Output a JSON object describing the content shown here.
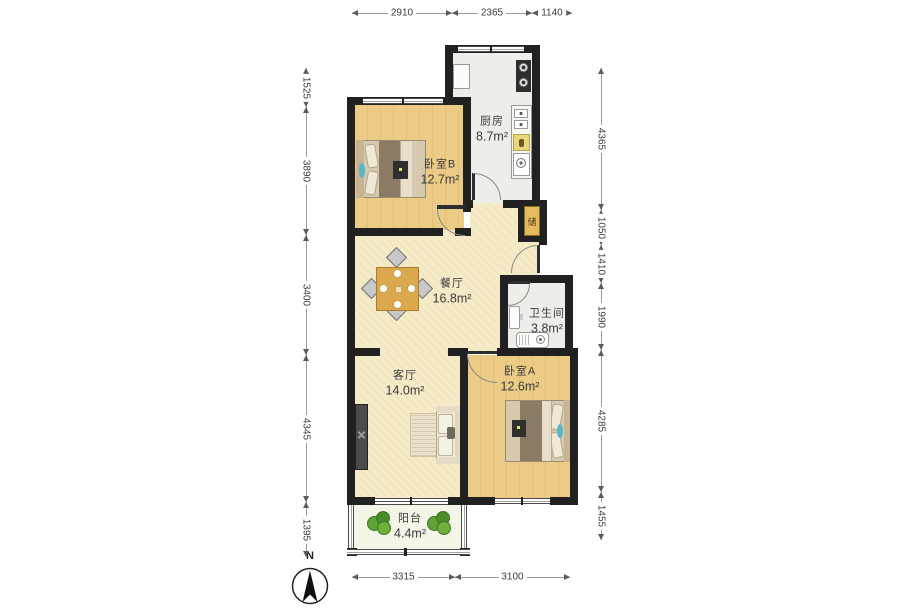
{
  "page": {
    "title": "Floor Plan"
  },
  "colors": {
    "wall": "#212121",
    "wood_floor": "#EBCB85",
    "cream_floor": "#F5EBC8",
    "tile_floor": "#EDEEE9",
    "balcony_floor": "#F3F5E6",
    "storage_cabinet": "#E4BC60",
    "plant_green": "#5FA235",
    "dim_line": "#9B9B9B",
    "dim_text": "#3C3C3C"
  },
  "compass": {
    "label": "N"
  },
  "storage": {
    "label": "储"
  },
  "rooms": [
    {
      "id": "kitchen",
      "name": "厨房",
      "area": "8.7m²",
      "cx": 492,
      "cy": 128
    },
    {
      "id": "bedroom-b",
      "name": "卧室B",
      "area": "12.7m²",
      "cx": 440,
      "cy": 171
    },
    {
      "id": "dining-room",
      "name": "餐厅",
      "area": "16.8m²",
      "cx": 452,
      "cy": 290
    },
    {
      "id": "bathroom",
      "name": "卫生间",
      "area": "3.8m²",
      "cx": 547,
      "cy": 320
    },
    {
      "id": "living-room",
      "name": "客厅",
      "area": "14.0m²",
      "cx": 405,
      "cy": 382
    },
    {
      "id": "bedroom-a",
      "name": "卧室A",
      "area": "12.6m²",
      "cx": 520,
      "cy": 378
    },
    {
      "id": "balcony",
      "name": "阳台",
      "area": "4.4m²",
      "cx": 410,
      "cy": 525
    }
  ],
  "dimensions": {
    "top": {
      "orientation": "h",
      "pos": 14,
      "segments": [
        {
          "label": "2910",
          "from": 352,
          "to": 452
        },
        {
          "label": "2365",
          "from": 452,
          "to": 532
        },
        {
          "label": "1140",
          "from": 532,
          "to": 572
        }
      ]
    },
    "bottom": {
      "orientation": "h",
      "pos": 578,
      "segments": [
        {
          "label": "3315",
          "from": 352,
          "to": 455
        },
        {
          "label": "3100",
          "from": 455,
          "to": 570
        }
      ]
    },
    "left": {
      "orientation": "v",
      "pos": 307,
      "segments": [
        {
          "label": "1525",
          "from": 68,
          "to": 107
        },
        {
          "label": "3890",
          "from": 107,
          "to": 235
        },
        {
          "label": "3400",
          "from": 235,
          "to": 355
        },
        {
          "label": "4345",
          "from": 355,
          "to": 502
        },
        {
          "label": "1395",
          "from": 502,
          "to": 557
        }
      ]
    },
    "right": {
      "orientation": "v",
      "pos": 602,
      "segments": [
        {
          "label": "4365",
          "from": 68,
          "to": 210
        },
        {
          "label": "1050",
          "from": 210,
          "to": 245
        },
        {
          "label": "1410",
          "from": 245,
          "to": 283
        },
        {
          "label": "1990",
          "from": 283,
          "to": 350
        },
        {
          "label": "4285",
          "from": 350,
          "to": 492
        },
        {
          "label": "1455",
          "from": 492,
          "to": 540
        }
      ]
    }
  }
}
